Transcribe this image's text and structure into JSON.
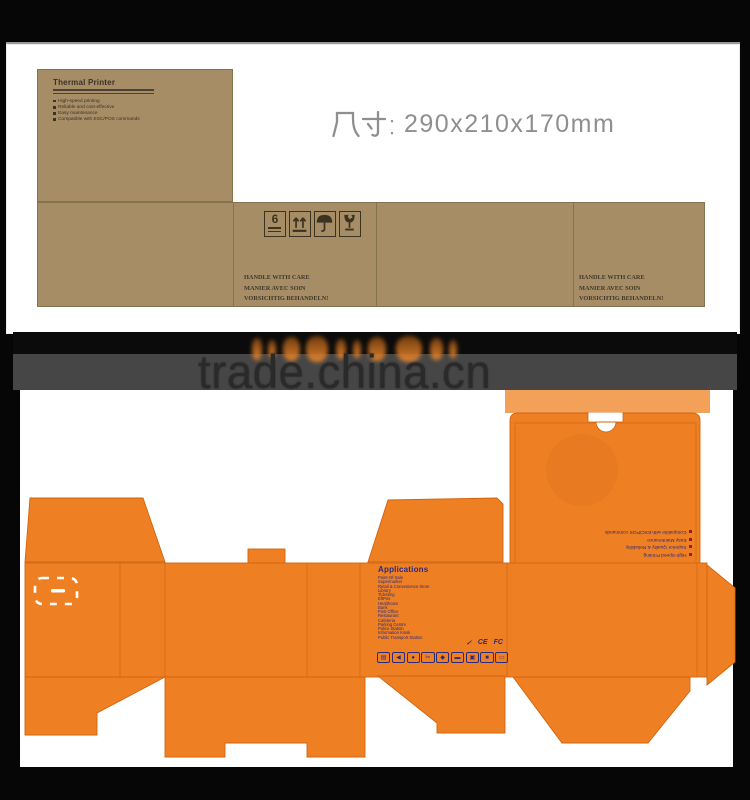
{
  "top_card": {
    "thermal_panel": {
      "title": "Thermal Printer",
      "features": [
        "High-speed printing",
        "Reliable and cost-effective",
        "Easy maintenance",
        "Compatible with ESC/POS commands"
      ]
    },
    "size_label": {
      "text": "尺寸: 290x210x170mm",
      "value": "290x210x170mm"
    },
    "handling_icons": [
      {
        "name": "stacking-limit-icon",
        "number": "6"
      },
      {
        "name": "this-way-up-icon"
      },
      {
        "name": "keep-dry-icon"
      },
      {
        "name": "fragile-icon"
      }
    ],
    "care_lines": [
      "HANDLE WITH CARE",
      "MANIER AVEC SOIN",
      "VORSICHTIG  BEHANDELN!"
    ]
  },
  "watermark": {
    "text": "trade.china.cn"
  },
  "box_design": {
    "features": [
      "High-Speed Printing",
      "Superior Quality & Reliability",
      "Easy Maintenance",
      "Compatible with ESC/POS commands"
    ],
    "applications": {
      "title": "Applications",
      "items": [
        "Point-Of-Sale",
        "Supermarket",
        "Retail & Convenience Store",
        "Library",
        "Ticketing",
        "EftPos",
        "Healthcare",
        "Bank",
        "Post Office",
        "Restaurant",
        "Cafeteria",
        "Parking Centre",
        "Police Station",
        "Information Kiosk",
        "Public Transport Station"
      ]
    },
    "cert_marks": [
      "✓",
      "CE",
      "FC"
    ],
    "app_icons": [
      {
        "name": "pos-receipt-icon",
        "glyph": "▤"
      },
      {
        "name": "speaker-icon",
        "glyph": "◀"
      },
      {
        "name": "printer-icon",
        "glyph": "●"
      },
      {
        "name": "scissors-icon",
        "glyph": "✂"
      },
      {
        "name": "pen-icon",
        "glyph": "◆"
      },
      {
        "name": "monitor-icon",
        "glyph": "▬"
      },
      {
        "name": "cash-register-icon",
        "glyph": "▣"
      },
      {
        "name": "computer-icon",
        "glyph": "■"
      },
      {
        "name": "display-icon",
        "glyph": "▭"
      }
    ]
  },
  "colors": {
    "kraft": "#a68d66",
    "orange": "#ef7f23",
    "orange_light": "#f3a159",
    "blue_ink": "#2b2b7e",
    "red_bullet": "#8c1f2f",
    "watermark_band": "#464646"
  }
}
